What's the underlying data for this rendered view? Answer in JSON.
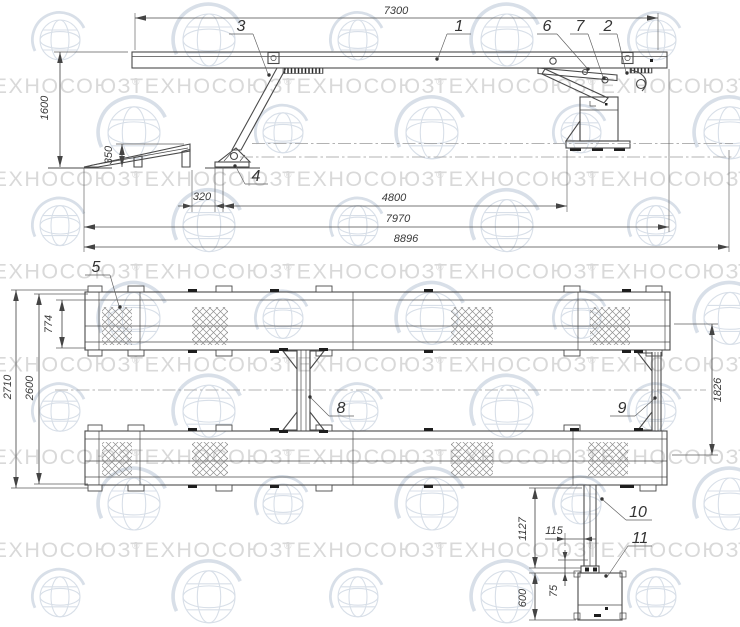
{
  "watermark": {
    "brand": "ТЕХНОСОЮЗ",
    "registered": "®"
  },
  "side_view": {
    "dims": {
      "top_length": "7300",
      "height": "1600",
      "ramp_height": "350",
      "ramp_gap": "320",
      "support_span": "4800",
      "platform_length": "7970",
      "overall_length": "8896"
    },
    "labels": {
      "platform": "1",
      "lock_bracket": "2",
      "support_leg": "3",
      "support_foot": "4",
      "link_front": "6",
      "link_rear": "7"
    }
  },
  "plan_view": {
    "dims": {
      "runway_width": "774",
      "overall_width": "2710",
      "inner_width": "2600",
      "runway_spacing": "1826",
      "post_length": "1127",
      "post_offset": "115",
      "box_offset": "75",
      "box_size": "600"
    },
    "labels": {
      "tread_pad": "5",
      "cross_member_left": "8",
      "cross_member_right": "9",
      "post_arm": "10",
      "control_box": "11"
    }
  }
}
